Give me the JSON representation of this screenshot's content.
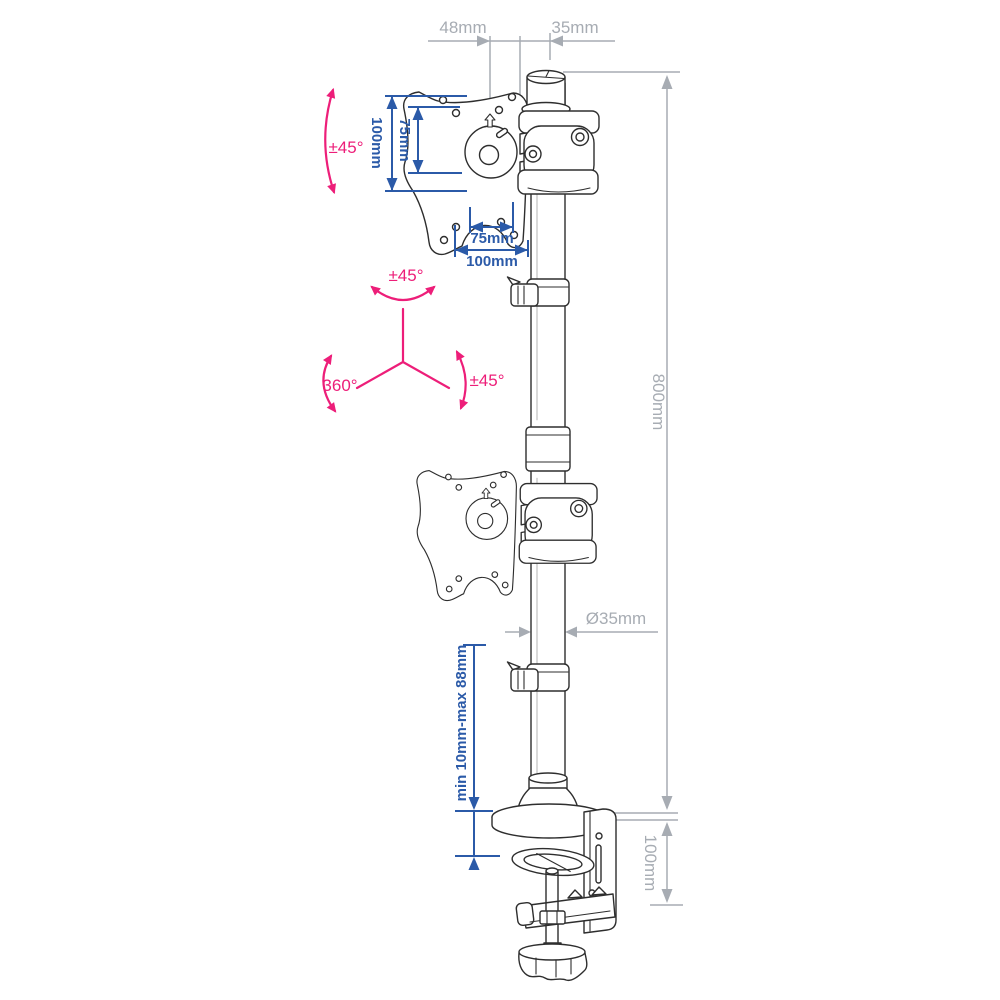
{
  "diagram": {
    "name": "dual-monitor-vertical-desk-mount-technical-drawing",
    "colors": {
      "line_art": "#2e2e2e",
      "dimension_gray": "#a7acb3",
      "dimension_blue": "#2b5aa8",
      "rotation_pink": "#ed1e79",
      "background": "#ffffff"
    },
    "dimensions": {
      "top": {
        "offset_from_plate": "48mm",
        "cap_width": "35mm"
      },
      "vesa": {
        "vertical_outer": "100mm",
        "vertical_inner": "75mm",
        "horizontal_inner": "75mm",
        "horizontal_outer": "100mm"
      },
      "pole": {
        "height": "800mm",
        "diameter": "Ø35mm"
      },
      "clamp": {
        "desk_thickness_range": "min 10mm-max 88mm",
        "clamp_height": "100mm"
      }
    },
    "rotation": {
      "tilt": "±45°",
      "swivel": "±45°",
      "base": "360°",
      "pivot": "±45°"
    }
  }
}
